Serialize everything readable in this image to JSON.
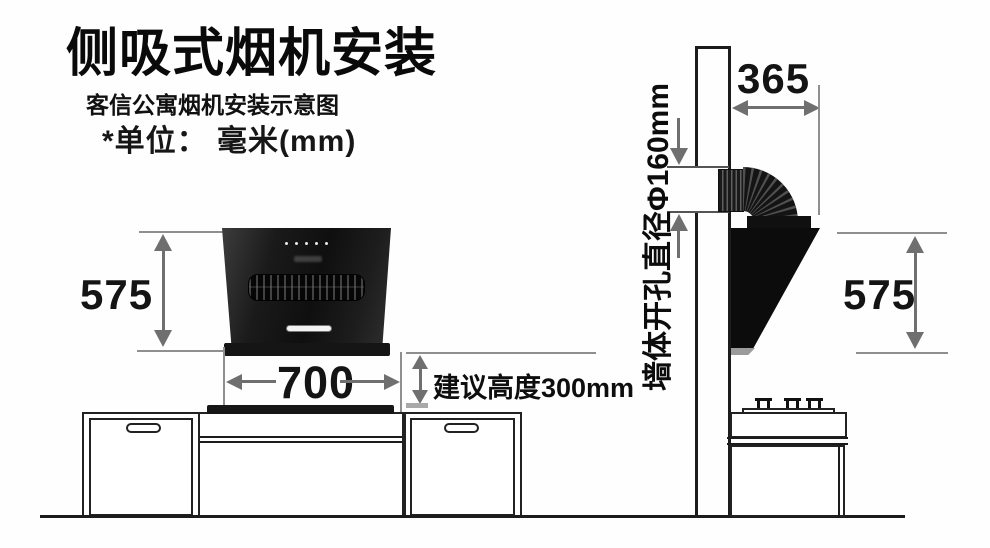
{
  "header": {
    "title": "侧吸式烟机安装",
    "subtitle": "客信公寓烟机安装示意图",
    "unit_note": "*单位： 毫米(mm)"
  },
  "front_view": {
    "height_mm": "575",
    "width_mm": "700",
    "clearance_note": "建议高度300mm"
  },
  "side_view": {
    "depth_mm": "365",
    "height_mm": "575",
    "wall_hole_note": "墙体开孔直径Φ160mm"
  },
  "colors": {
    "hood_black": "#0c0c0c",
    "line_ink": "#1c1c1c",
    "arrow_gray": "#6f6f6f",
    "extension_gray": "#8f8f8f"
  }
}
